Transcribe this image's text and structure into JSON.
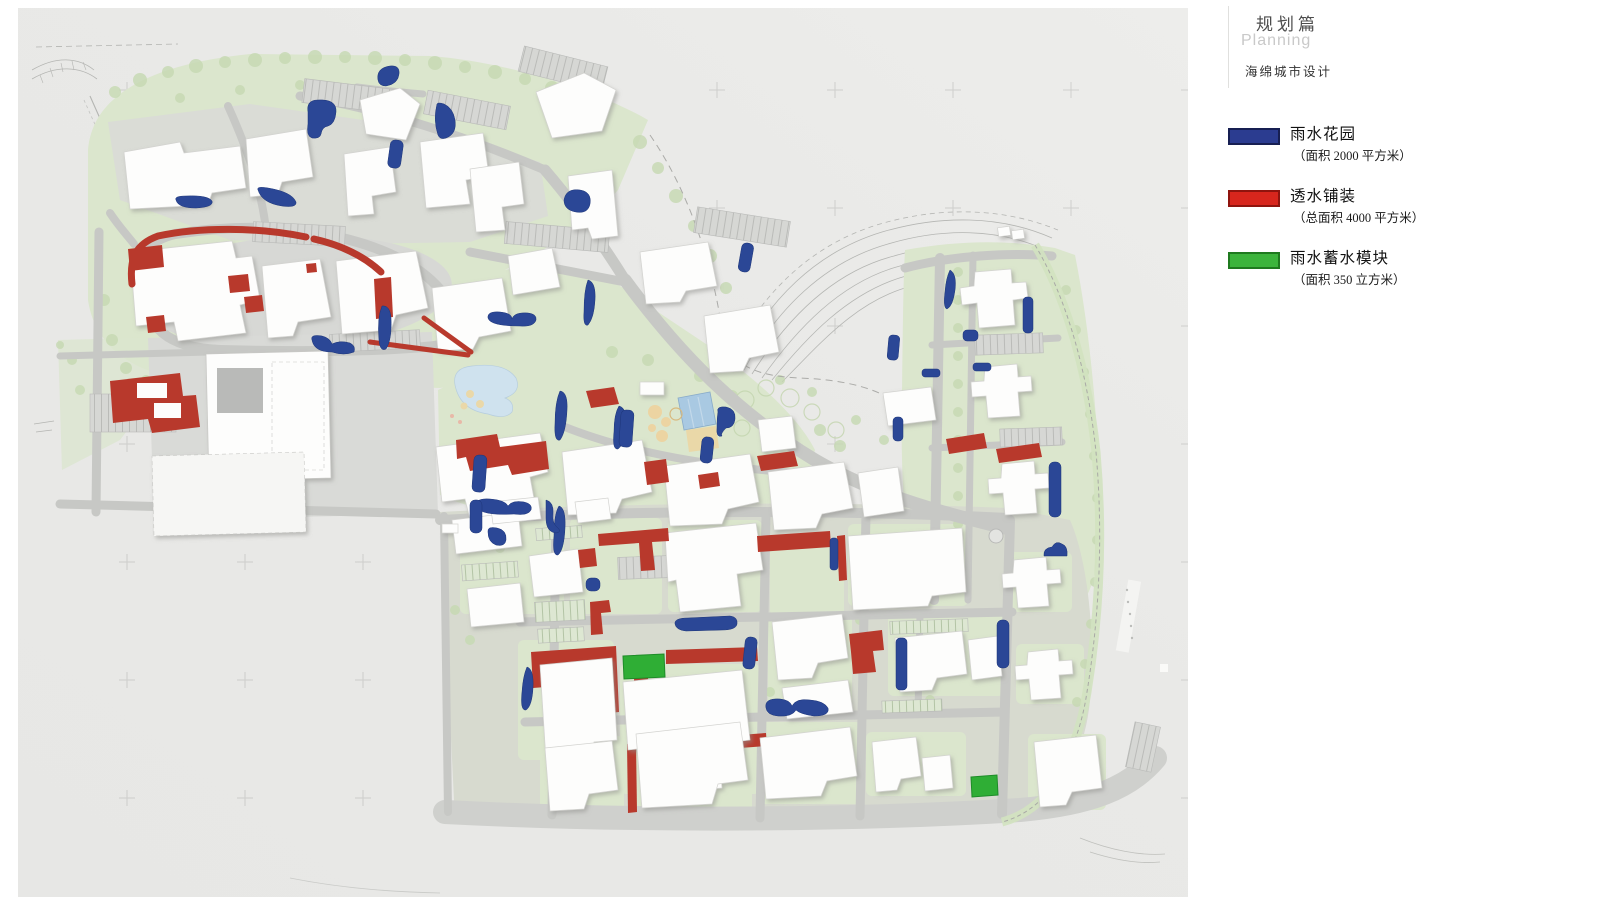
{
  "header": {
    "section_zh": "规划篇",
    "section_en": "Planning",
    "subtitle": "海绵城市设计"
  },
  "legend": {
    "items": [
      {
        "label": "雨水花园",
        "detail": "（面积 2000 平方米）",
        "color": "#2b3c90",
        "border_color": "#171f52",
        "swatch_style": "background:#2b3c90;border:2px solid #171f52"
      },
      {
        "label": "透水铺装",
        "detail": "（总面积 4000 平方米）",
        "color": "#d7261d",
        "border_color": "#8f140e",
        "swatch_style": "background:#d7261d;border:2px solid #8f140e"
      },
      {
        "label": "雨水蓄水模块",
        "detail": "（面积 350 立方米）",
        "color": "#3cb43c",
        "border_color": "#1f7a1f",
        "swatch_style": "background:#3cb43c;border:2px solid #1f7a1f"
      }
    ]
  },
  "map": {
    "colors": {
      "rain_garden": "#2b4796",
      "permeable_paving": "#b8392c",
      "storage_module": "#2fae35"
    }
  }
}
